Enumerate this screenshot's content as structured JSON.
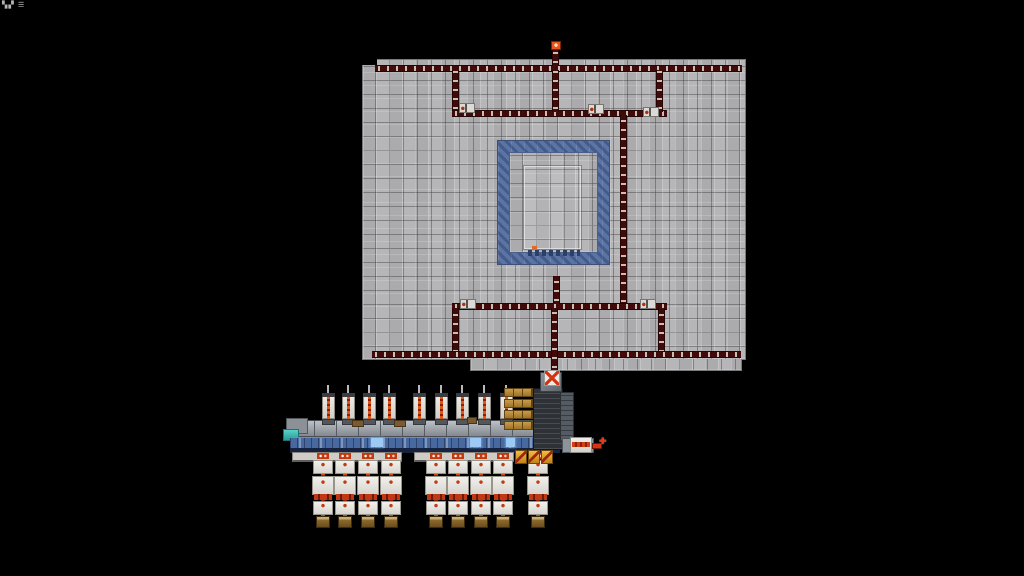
{
  "meta": {
    "background": "#000000",
    "width": 1024,
    "height": 576
  },
  "hud": {
    "text": "▚▞ ☰"
  },
  "colors": {
    "platform_tile": "#b2b2b4",
    "platform_line": "#4a4a4c",
    "belt": "#420b0b",
    "belt_item": "#c9bfb2",
    "ring_blue": "#5b74a6",
    "conveyor_blue": "#4868a0",
    "conveyor_dark": "#16223e",
    "light_cargo_blue": "#9ccaf4",
    "teal": "#3fbdb5",
    "machine_white": "#e9e7e3",
    "hot_red": "#d2491c",
    "dark_red": "#8f2008",
    "chest_brown": "#7c5a2a",
    "gold": "#b78a38",
    "chest_yellow": "#e8a61e",
    "elevator_gray": "#2e3136",
    "port_orange": "#e8541c"
  },
  "scene": {
    "platform": {
      "x": 362,
      "y": 59,
      "w": 384,
      "h": 301
    },
    "belts": [
      [
        375,
        65,
        367,
        7,
        "h"
      ],
      [
        552,
        44,
        7,
        22,
        "v"
      ],
      [
        452,
        70,
        7,
        42,
        "v"
      ],
      [
        452,
        110,
        215,
        7,
        "h"
      ],
      [
        552,
        70,
        7,
        42,
        "v"
      ],
      [
        656,
        70,
        7,
        42,
        "v"
      ],
      [
        620,
        115,
        7,
        190,
        "v"
      ],
      [
        452,
        303,
        215,
        7,
        "h"
      ],
      [
        553,
        276,
        7,
        28,
        "v"
      ],
      [
        452,
        308,
        7,
        47,
        "v"
      ],
      [
        658,
        308,
        7,
        47,
        "v"
      ],
      [
        372,
        351,
        369,
        7,
        "h"
      ],
      [
        551,
        308,
        7,
        72,
        "v"
      ]
    ],
    "splitters": [
      [
        459,
        103
      ],
      [
        588,
        104
      ],
      [
        643,
        107
      ],
      [
        460,
        299
      ],
      [
        640,
        299
      ]
    ],
    "ports": [
      [
        551,
        41
      ],
      [
        548,
        371
      ]
    ],
    "factory": {
      "top_machines": [
        328,
        348,
        369,
        389,
        419,
        441,
        462,
        484,
        506
      ],
      "columns": [
        323,
        345,
        368,
        391,
        436,
        458,
        481,
        503,
        538
      ],
      "light_patches": [
        [
          371,
          12
        ],
        [
          470,
          11
        ],
        [
          506,
          9
        ]
      ],
      "subbands": [
        [
          292,
          110
        ],
        [
          414,
          100
        ]
      ],
      "gold_stack": {
        "x": 504,
        "y": 388,
        "count": 4,
        "gap": 11
      },
      "yellow_chests": [
        515,
        528,
        541
      ],
      "brown_bits": [
        [
          352,
          420,
          12,
          7
        ],
        [
          394,
          420,
          12,
          7
        ],
        [
          467,
          417,
          10,
          7
        ]
      ],
      "right_machine_cross": "✚"
    }
  }
}
